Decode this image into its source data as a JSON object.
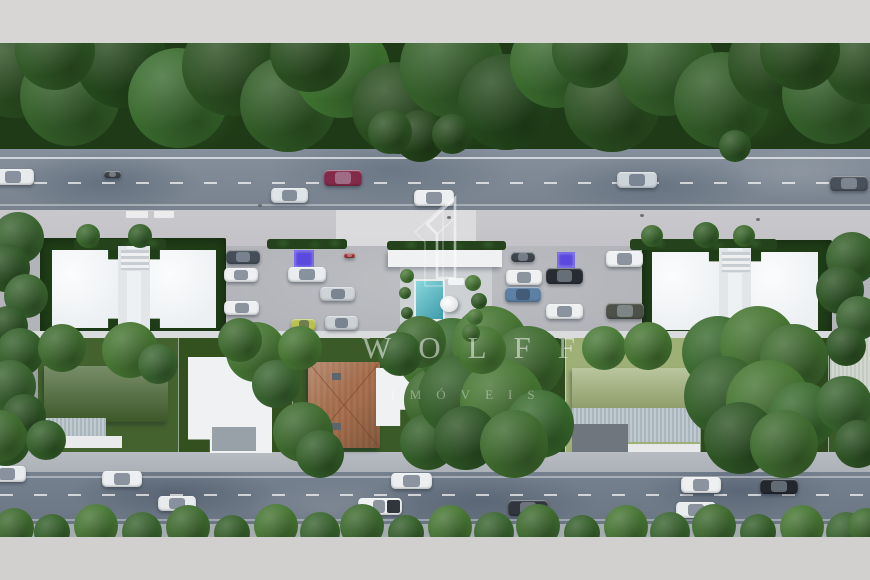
{
  "watermark": {
    "brand": "WOLFF",
    "subtitle": "IMÓVEIS"
  },
  "palette": {
    "letterbox_bar": "#d8d6d4",
    "road_asphalt": "#7b8793",
    "sidewalk": "#c6c5c9",
    "parking_pavement": "#b3b5b9",
    "building_roof": "#f2f4f6",
    "lawn_dark": "#2f4a22",
    "lawn_light": "#9fb077",
    "tree_green": "#35602a",
    "pool_teal": "#48a7b4",
    "terracotta_roof": "#a9714f",
    "parking_marker_purple": "#5a49dd",
    "watermark_white": "rgba(255,255,255,0.5)"
  },
  "scene": {
    "cars": {
      "top_road": [
        {
          "x": -8,
          "y": 169,
          "w": 42,
          "h": 16,
          "color": "#e8ebee"
        },
        {
          "x": 104,
          "y": 171,
          "w": 17,
          "h": 7,
          "color": "#3c4248",
          "dark": true
        },
        {
          "x": 271,
          "y": 188,
          "w": 37,
          "h": 15,
          "color": "#dfe4e8"
        },
        {
          "x": 324,
          "y": 170,
          "w": 38,
          "h": 16,
          "color": "#83294a",
          "dark": true
        },
        {
          "x": 414,
          "y": 190,
          "w": 40,
          "h": 16,
          "color": "#eceff1"
        },
        {
          "x": 617,
          "y": 172,
          "w": 40,
          "h": 16,
          "color": "#ccd4da"
        },
        {
          "x": 830,
          "y": 176,
          "w": 38,
          "h": 15,
          "color": "#495059",
          "dark": true
        }
      ],
      "parking_left": [
        {
          "x": 226,
          "y": 250,
          "w": 34,
          "h": 14,
          "color": "#454d57",
          "dark": true
        },
        {
          "x": 224,
          "y": 268,
          "w": 34,
          "h": 14,
          "color": "#eef0f2"
        },
        {
          "x": 224,
          "y": 301,
          "w": 35,
          "h": 14,
          "color": "#edeff1"
        },
        {
          "x": 288,
          "y": 267,
          "w": 38,
          "h": 15,
          "color": "#e9edf0"
        },
        {
          "x": 320,
          "y": 287,
          "w": 35,
          "h": 14,
          "color": "#ced3d8"
        },
        {
          "x": 291,
          "y": 319,
          "w": 25,
          "h": 12,
          "color": "#b9c24f"
        },
        {
          "x": 325,
          "y": 316,
          "w": 33,
          "h": 14,
          "color": "#ccd1d6"
        },
        {
          "x": 344,
          "y": 253,
          "w": 11,
          "h": 5,
          "color": "#a33636",
          "dark": true
        }
      ],
      "parking_right": [
        {
          "x": 511,
          "y": 252,
          "w": 24,
          "h": 10,
          "color": "#3e444c",
          "dark": true
        },
        {
          "x": 506,
          "y": 270,
          "w": 36,
          "h": 15,
          "color": "#eef0f2"
        },
        {
          "x": 505,
          "y": 287,
          "w": 36,
          "h": 15,
          "color": "#5d80a5"
        },
        {
          "x": 546,
          "y": 268,
          "w": 37,
          "h": 16,
          "color": "#272c33",
          "dark": true
        },
        {
          "x": 546,
          "y": 304,
          "w": 37,
          "h": 15,
          "color": "#edeff1"
        },
        {
          "x": 606,
          "y": 251,
          "w": 37,
          "h": 16,
          "color": "#eff1f3"
        },
        {
          "x": 606,
          "y": 303,
          "w": 38,
          "h": 16,
          "color": "#4c5149",
          "dark": true
        }
      ],
      "bottom_road": [
        {
          "x": -12,
          "y": 466,
          "w": 38,
          "h": 16,
          "color": "#e8ebee"
        },
        {
          "x": 102,
          "y": 471,
          "w": 40,
          "h": 16,
          "color": "#eceff1"
        },
        {
          "x": 158,
          "y": 496,
          "w": 38,
          "h": 15,
          "color": "#e8ebee"
        },
        {
          "x": 358,
          "y": 498,
          "w": 44,
          "h": 17,
          "color": "#eef0f2",
          "type": "pickup"
        },
        {
          "x": 391,
          "y": 473,
          "w": 41,
          "h": 16,
          "color": "#eceff1"
        },
        {
          "x": 508,
          "y": 500,
          "w": 40,
          "h": 16,
          "color": "#31363e",
          "dark": true
        },
        {
          "x": 681,
          "y": 477,
          "w": 40,
          "h": 16,
          "color": "#edeff1"
        },
        {
          "x": 760,
          "y": 479,
          "w": 38,
          "h": 15,
          "color": "#23272e",
          "dark": true
        },
        {
          "x": 676,
          "y": 502,
          "w": 40,
          "h": 16,
          "color": "#eaedef"
        }
      ]
    },
    "parking_markers": [
      {
        "x": 294,
        "y": 250,
        "w": 18,
        "h": 16
      },
      {
        "x": 557,
        "y": 252,
        "w": 16,
        "h": 14
      }
    ],
    "vegetation": [
      [
        15,
        70,
        48,
        "#2c5122"
      ],
      [
        70,
        96,
        50,
        "#35602a"
      ],
      [
        122,
        62,
        46,
        "#254a1d"
      ],
      [
        178,
        98,
        50,
        "#3a6b2e"
      ],
      [
        232,
        66,
        50,
        "#2c5122"
      ],
      [
        288,
        104,
        48,
        "#325c27"
      ],
      [
        342,
        70,
        48,
        "#3f7431"
      ],
      [
        398,
        108,
        46,
        "#2a4e20"
      ],
      [
        452,
        66,
        52,
        "#35602a"
      ],
      [
        506,
        102,
        48,
        "#254a1d"
      ],
      [
        556,
        62,
        46,
        "#3a6b2e"
      ],
      [
        612,
        104,
        48,
        "#2c5122"
      ],
      [
        666,
        66,
        50,
        "#35602a"
      ],
      [
        722,
        100,
        48,
        "#325c27"
      ],
      [
        776,
        62,
        48,
        "#2a4e20"
      ],
      [
        832,
        94,
        50,
        "#35602a"
      ],
      [
        866,
        62,
        42,
        "#2c5122"
      ],
      [
        55,
        50,
        40,
        "#305826"
      ],
      [
        310,
        52,
        40,
        "#2b5021"
      ],
      [
        590,
        50,
        38,
        "#305826"
      ],
      [
        800,
        50,
        40,
        "#2b5021"
      ],
      [
        420,
        136,
        26,
        "#24451a"
      ],
      [
        390,
        132,
        22,
        "#2e5424"
      ],
      [
        452,
        134,
        20,
        "#2a4e20"
      ],
      [
        735,
        146,
        16,
        "#2f5725"
      ],
      [
        18,
        238,
        26,
        "#3a6430"
      ],
      [
        6,
        268,
        24,
        "#2f5626"
      ],
      [
        26,
        296,
        22,
        "#3a6430"
      ],
      [
        8,
        326,
        20,
        "#2f5626"
      ],
      [
        20,
        352,
        24,
        "#35602a"
      ],
      [
        10,
        386,
        26,
        "#3a6430"
      ],
      [
        24,
        416,
        22,
        "#2f5626"
      ],
      [
        6,
        442,
        24,
        "#35602a"
      ],
      [
        852,
        258,
        26,
        "#35602a"
      ],
      [
        840,
        290,
        24,
        "#2f5626"
      ],
      [
        858,
        318,
        22,
        "#3a6430"
      ],
      [
        846,
        346,
        20,
        "#2f5626"
      ],
      [
        88,
        236,
        12,
        "#3c6a2e"
      ],
      [
        140,
        236,
        12,
        "#35602a"
      ],
      [
        652,
        236,
        11,
        "#3c6a2e"
      ],
      [
        706,
        235,
        13,
        "#35602a"
      ],
      [
        744,
        236,
        11,
        "#3c6a2e"
      ],
      [
        62,
        348,
        24,
        "#3f6b2f"
      ],
      [
        130,
        350,
        28,
        "#477633"
      ],
      [
        158,
        364,
        20,
        "#3a6530"
      ],
      [
        46,
        440,
        20,
        "#35602a"
      ],
      [
        256,
        352,
        30,
        "#477633"
      ],
      [
        276,
        384,
        24,
        "#3a6530"
      ],
      [
        240,
        340,
        22,
        "#3f6b2f"
      ],
      [
        303,
        432,
        30,
        "#3f6b2f"
      ],
      [
        320,
        454,
        24,
        "#35602a"
      ],
      [
        300,
        348,
        22,
        "#477633"
      ],
      [
        430,
        358,
        32,
        "#477633"
      ],
      [
        436,
        400,
        32,
        "#3f6b2f"
      ],
      [
        428,
        442,
        28,
        "#35602a"
      ],
      [
        452,
        352,
        34,
        "#3a6b2e"
      ],
      [
        490,
        344,
        38,
        "#477633"
      ],
      [
        528,
        362,
        36,
        "#3f6b2f"
      ],
      [
        458,
        396,
        40,
        "#35602a"
      ],
      [
        502,
        402,
        42,
        "#477633"
      ],
      [
        540,
        424,
        34,
        "#3a6b2e"
      ],
      [
        466,
        438,
        32,
        "#2f5626"
      ],
      [
        514,
        444,
        34,
        "#3f6b2f"
      ],
      [
        420,
        342,
        26,
        "#3f6b2f"
      ],
      [
        400,
        354,
        22,
        "#35602a"
      ],
      [
        482,
        350,
        24,
        "#477633"
      ],
      [
        604,
        348,
        22,
        "#4a7a38"
      ],
      [
        648,
        346,
        24,
        "#477633"
      ],
      [
        718,
        352,
        36,
        "#3a6b2e"
      ],
      [
        758,
        344,
        38,
        "#477633"
      ],
      [
        794,
        358,
        34,
        "#3f6b2f"
      ],
      [
        724,
        396,
        40,
        "#35602a"
      ],
      [
        768,
        402,
        42,
        "#477633"
      ],
      [
        802,
        416,
        34,
        "#3a6b2e"
      ],
      [
        740,
        438,
        36,
        "#2f5626"
      ],
      [
        784,
        444,
        34,
        "#3f6b2f"
      ],
      [
        844,
        404,
        28,
        "#3a6530"
      ],
      [
        858,
        444,
        24,
        "#2f5626"
      ],
      [
        407,
        276,
        7,
        "#4a7a38"
      ],
      [
        405,
        293,
        6,
        "#3f6b2f"
      ],
      [
        473,
        283,
        8,
        "#4a7a38"
      ],
      [
        479,
        301,
        8,
        "#35602a"
      ],
      [
        475,
        317,
        8,
        "#4a7a38"
      ],
      [
        407,
        313,
        6,
        "#35602a"
      ],
      [
        471,
        333,
        9,
        "#3f6b2f"
      ],
      [
        14,
        528,
        20,
        "#3f6b2f"
      ],
      [
        52,
        532,
        18,
        "#35602a"
      ],
      [
        96,
        526,
        22,
        "#477633"
      ],
      [
        142,
        532,
        20,
        "#3a6530"
      ],
      [
        188,
        527,
        22,
        "#3f6b2f"
      ],
      [
        232,
        533,
        18,
        "#35602a"
      ],
      [
        276,
        526,
        22,
        "#477633"
      ],
      [
        320,
        532,
        20,
        "#3a6530"
      ],
      [
        362,
        526,
        22,
        "#3f6b2f"
      ],
      [
        406,
        533,
        18,
        "#35602a"
      ],
      [
        450,
        527,
        22,
        "#477633"
      ],
      [
        494,
        532,
        20,
        "#3a6530"
      ],
      [
        538,
        526,
        22,
        "#3f6b2f"
      ],
      [
        582,
        533,
        18,
        "#35602a"
      ],
      [
        626,
        527,
        22,
        "#477633"
      ],
      [
        670,
        532,
        20,
        "#3a6530"
      ],
      [
        714,
        526,
        22,
        "#3f6b2f"
      ],
      [
        758,
        532,
        18,
        "#35602a"
      ],
      [
        802,
        527,
        22,
        "#477633"
      ],
      [
        846,
        532,
        20,
        "#3a6530"
      ],
      [
        866,
        526,
        18,
        "#3f6b2f"
      ],
      [
        0,
        436,
        26,
        "#3f6b2f"
      ]
    ]
  }
}
